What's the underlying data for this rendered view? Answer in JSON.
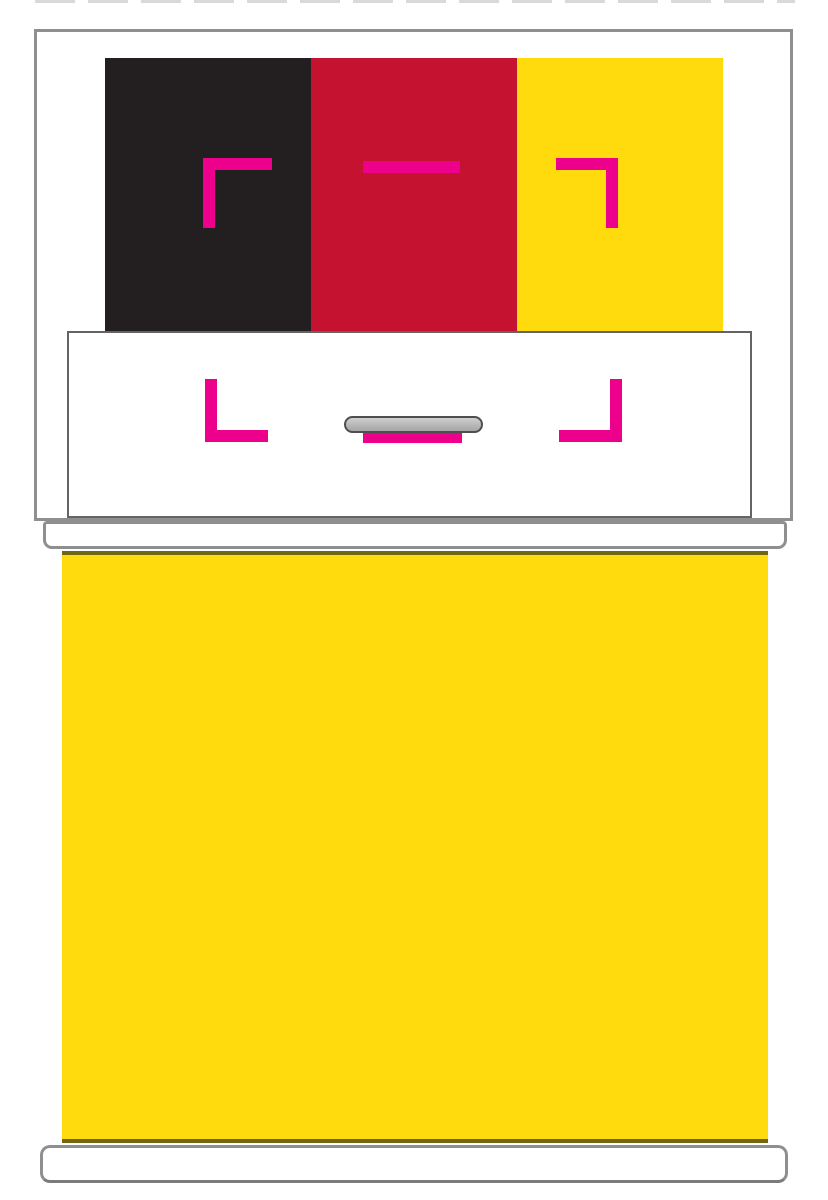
{
  "mockup": {
    "colors": {
      "stripe_black": "#231F20",
      "stripe_red": "#C41230",
      "stripe_yellow": "#FFDB0E",
      "body_yellow": "#FFDB0E",
      "crop_mark_pink": "#EC008C",
      "outline_gray": "#8F8F8F",
      "band_outline_gray": "#646464",
      "handle_gray": "#B7B7B7",
      "handle_outline": "#4F4F4F",
      "body_edge_olive": "#6F6713",
      "cut_line_gray": "#D9D9D9",
      "background": "#FFFFFF"
    },
    "flag_stripes": [
      {
        "name": "black",
        "color": "#231F20"
      },
      {
        "name": "red",
        "color": "#C41230"
      },
      {
        "name": "yellow",
        "color": "#FFDB0E"
      }
    ],
    "icons": {
      "top_left": "crop-mark-top-left-icon",
      "top_center": "crop-mark-top-center-icon",
      "top_right": "crop-mark-top-right-icon",
      "bottom_left": "crop-mark-bottom-left-icon",
      "bottom_center": "crop-mark-bottom-center-icon",
      "bottom_right": "crop-mark-bottom-right-icon",
      "handle": "handle-slot-icon",
      "cut_line": "dashed-cut-line-icon"
    }
  }
}
